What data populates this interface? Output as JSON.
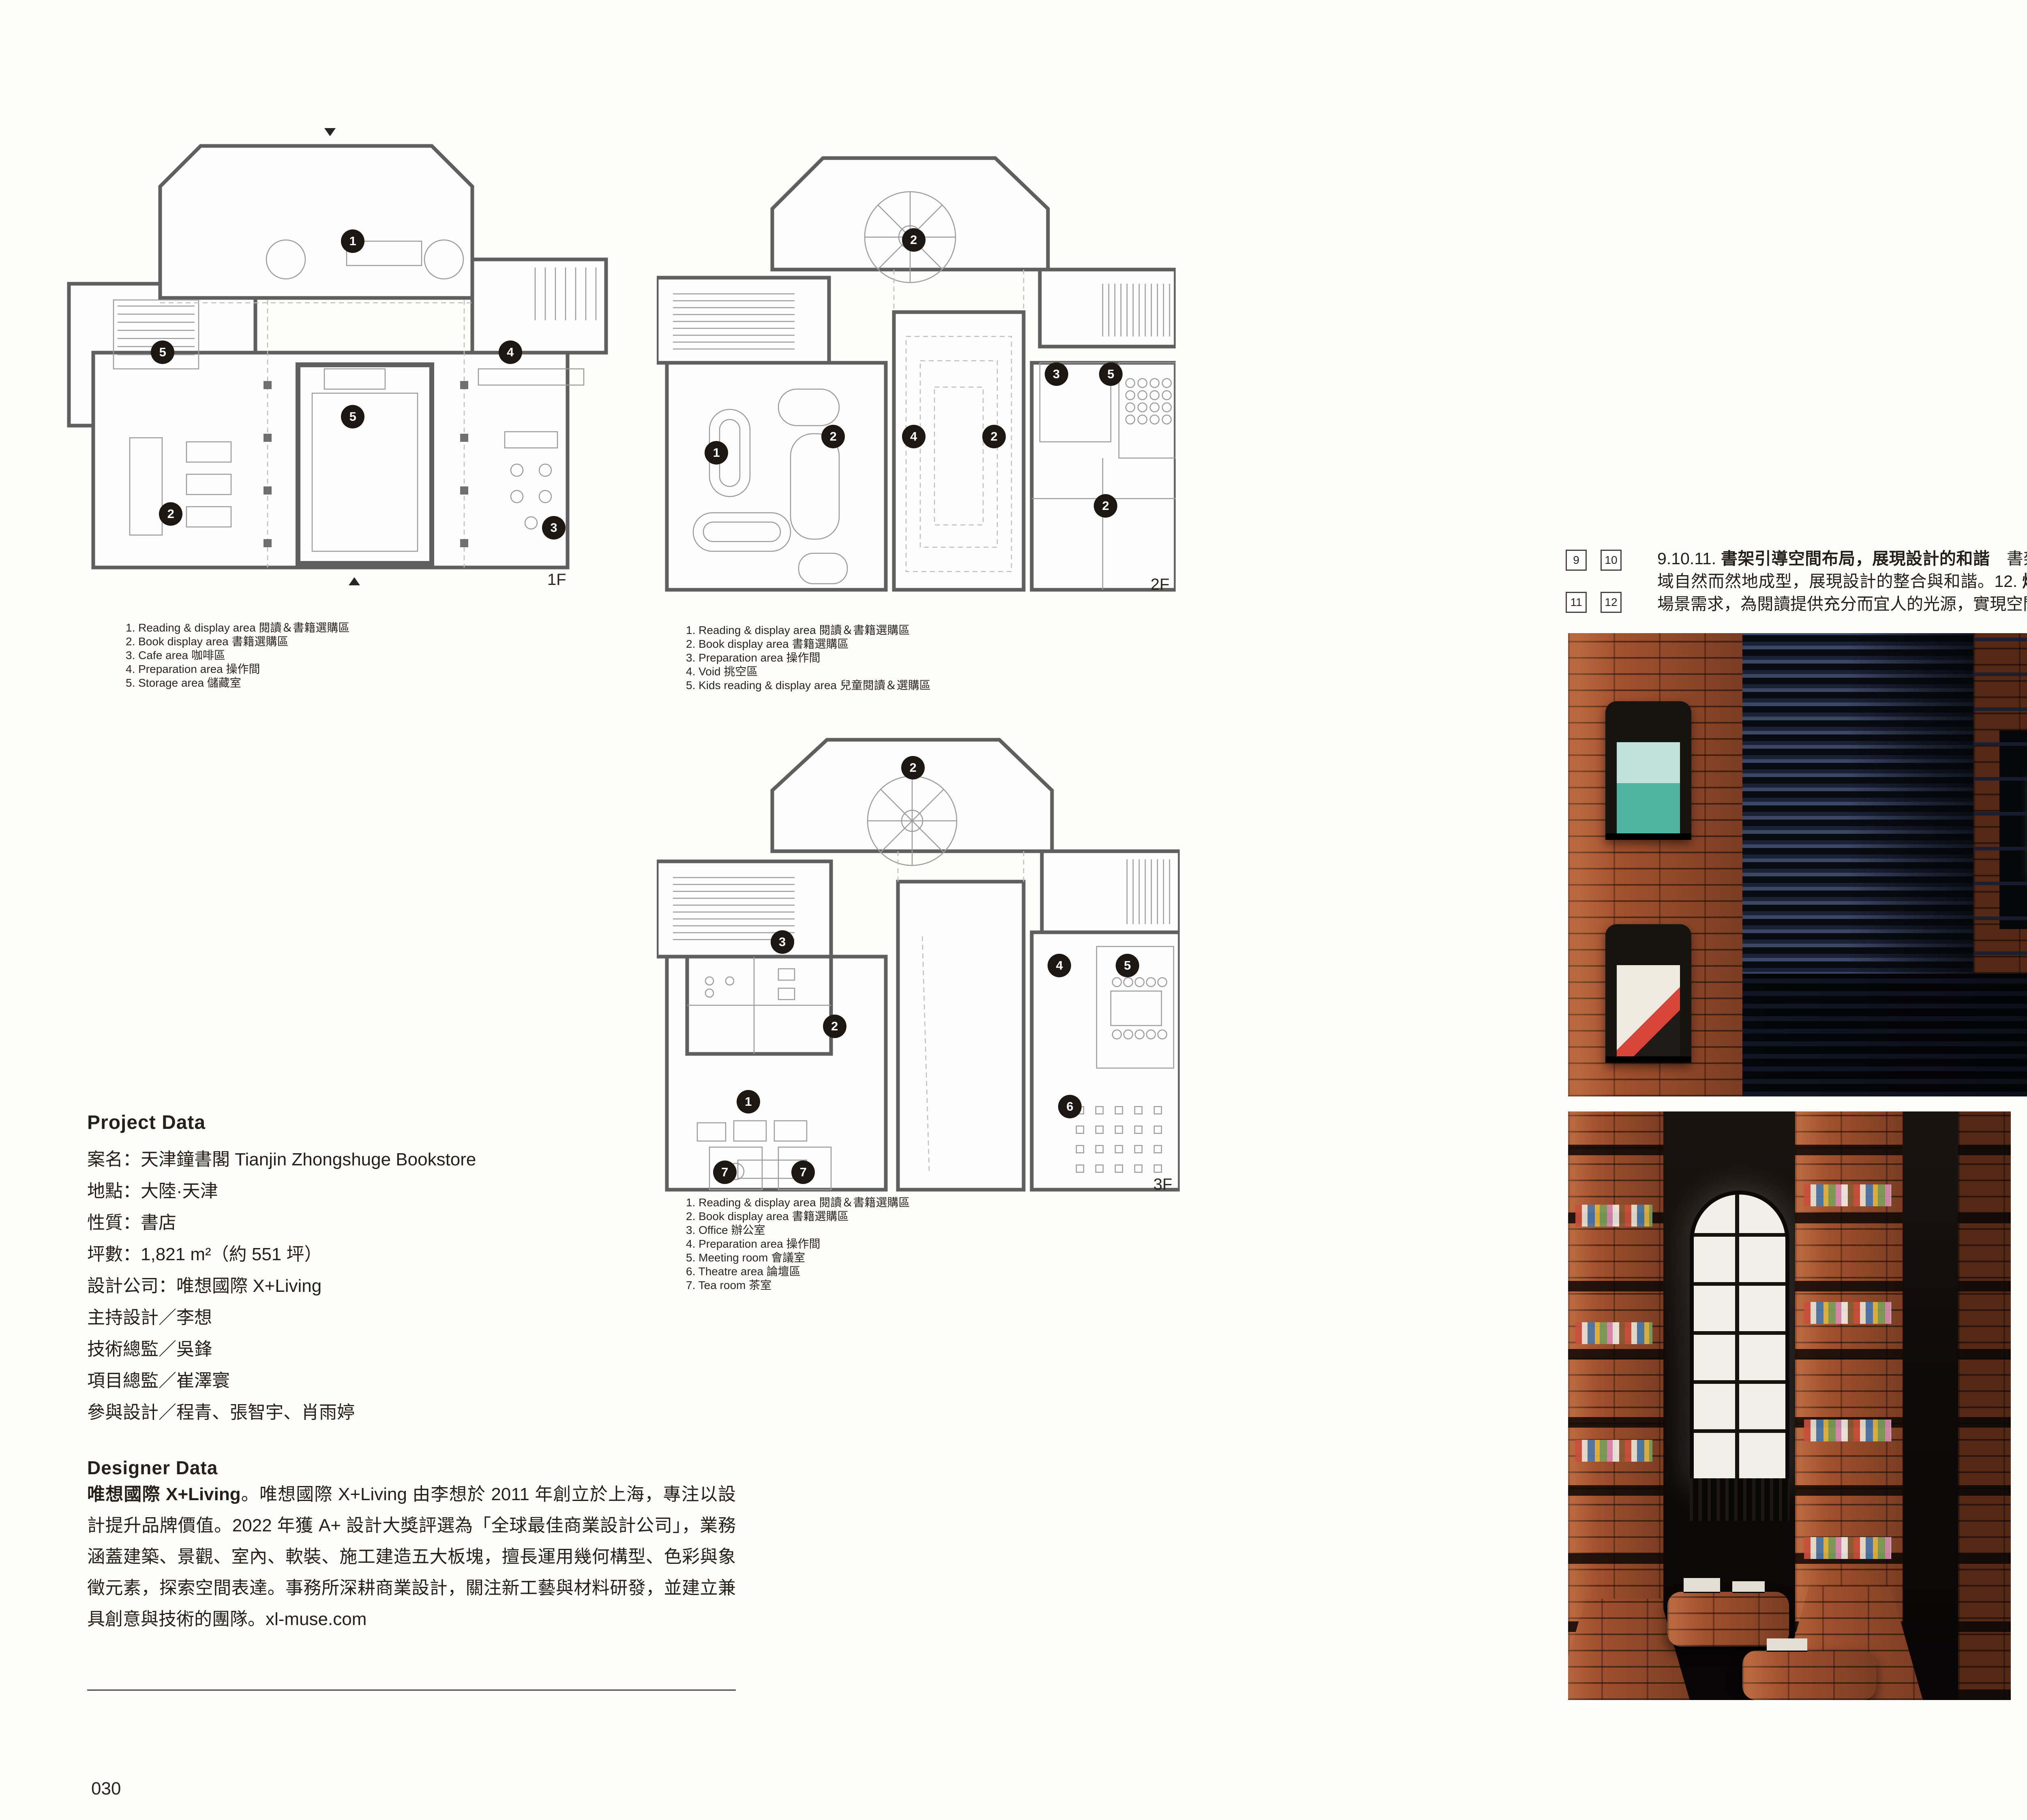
{
  "palette": {
    "brick": "#a2512e",
    "slat_navy": "#2b3454",
    "skylight": "#f4f1e8",
    "ink": "#262019"
  },
  "header": {
    "brand": "DESIGN"
  },
  "sidebar_label": "INTERIOR",
  "pages": {
    "left": "030",
    "right": "031"
  },
  "plans": [
    {
      "label": "1F",
      "legend": [
        "1. Reading & display area 閱讀＆書籍選購區",
        "2. Book display area 書籍選購區",
        "3. Cafe area 咖啡區",
        "4. Preparation area 操作間",
        "5. Storage area 儲藏室"
      ],
      "markers": [
        {
          "n": "1",
          "x": 53,
          "y": 25
        },
        {
          "n": "5",
          "x": 18,
          "y": 49
        },
        {
          "n": "4",
          "x": 82,
          "y": 49
        },
        {
          "n": "5",
          "x": 53,
          "y": 63
        },
        {
          "n": "2",
          "x": 19.5,
          "y": 84
        },
        {
          "n": "3",
          "x": 90,
          "y": 87
        }
      ]
    },
    {
      "label": "2F",
      "legend": [
        "1. Reading & display area 閱讀＆書籍選購區",
        "2. Book display area 書籍選購區",
        "3. Preparation area 操作間",
        "4. Void 挑空區",
        "5. Kids reading & display area 兒童閱讀＆選購區"
      ],
      "markers": [
        {
          "n": "2",
          "x": 49.5,
          "y": 23
        },
        {
          "n": "3",
          "x": 77,
          "y": 52
        },
        {
          "n": "5",
          "x": 87.5,
          "y": 52
        },
        {
          "n": "2",
          "x": 34,
          "y": 65.5
        },
        {
          "n": "4",
          "x": 49.5,
          "y": 65.5
        },
        {
          "n": "2",
          "x": 65,
          "y": 65.5
        },
        {
          "n": "1",
          "x": 11.5,
          "y": 69
        },
        {
          "n": "2",
          "x": 86.5,
          "y": 80.5
        }
      ]
    },
    {
      "label": "3F",
      "legend": [
        "1. Reading & display area 閱讀＆書籍選購區",
        "2. Book display area 書籍選購區",
        "3. Office 辦公室",
        "4. Preparation area 操作間",
        "5. Meeting room 會議室",
        "6. Theatre area 論壇區",
        "7. Tea room 茶室"
      ],
      "markers": [
        {
          "n": "2",
          "x": 49,
          "y": 9
        },
        {
          "n": "3",
          "x": 24,
          "y": 46
        },
        {
          "n": "4",
          "x": 77,
          "y": 51
        },
        {
          "n": "5",
          "x": 90,
          "y": 51
        },
        {
          "n": "2",
          "x": 34,
          "y": 64
        },
        {
          "n": "1",
          "x": 17.5,
          "y": 80
        },
        {
          "n": "6",
          "x": 79,
          "y": 81
        },
        {
          "n": "7",
          "x": 13,
          "y": 95
        },
        {
          "n": "7",
          "x": 28,
          "y": 95
        }
      ]
    }
  ],
  "project_data": {
    "heading": "Project Data",
    "rows": [
      "案名：天津鐘書閣 Tianjin Zhongshuge Bookstore",
      "地點：大陸·天津",
      "性質：書店",
      "坪數：1,821 m²（約 551 坪）",
      "設計公司：唯想國際 X+Living",
      "主持設計／李想",
      "技術總監／吳鋒",
      "項目總監／崔澤寰",
      "參與設計／程青、張智宇、肖雨婷"
    ]
  },
  "designer_data": {
    "heading": "Designer Data",
    "lead": "唯想國際 X+Living",
    "body": "。唯想國際 X+Living 由李想於 2011 年創立於上海，專注以設計提升品牌價值。2022 年獲 A+ 設計大獎評選為「全球最佳商業設計公司」，業務涵蓋建築、景觀、室內、軟裝、施工建造五大板塊，擅長運用幾何構型、色彩與象徵元素，探索空間表達。事務所深耕商業設計，關注新工藝與材料研發，並建立兼具創意與技術的團隊。xl-muse.com"
  },
  "article": {
    "figure_refs": [
      "9",
      "10",
      "11",
      "12"
    ],
    "segments": [
      {
        "bold": false,
        "text": "9.10.11. "
      },
      {
        "bold": true,
        "text": "書架引導空間布局，展現設計的和諧"
      },
      {
        "bold": false,
        "text": "　書架隨著空間自然延展，順勢引導出座位與階梯的配置，功能區域自然而然地成型，展現設計的整合與和諧。12. "
      },
      {
        "bold": true,
        "text": "燈光設計模擬自然天光，塑造空間氛圍"
      },
      {
        "bold": false,
        "text": "　咖啡區燈光設計貼合場景需求，為閱讀提供充分而宜人的光源，實現空間延伸感與視覺舒適度雙重提升。"
      }
    ],
    "credit": "圖片提供｜唯想國際 X+Living　攝影｜SFAP"
  }
}
